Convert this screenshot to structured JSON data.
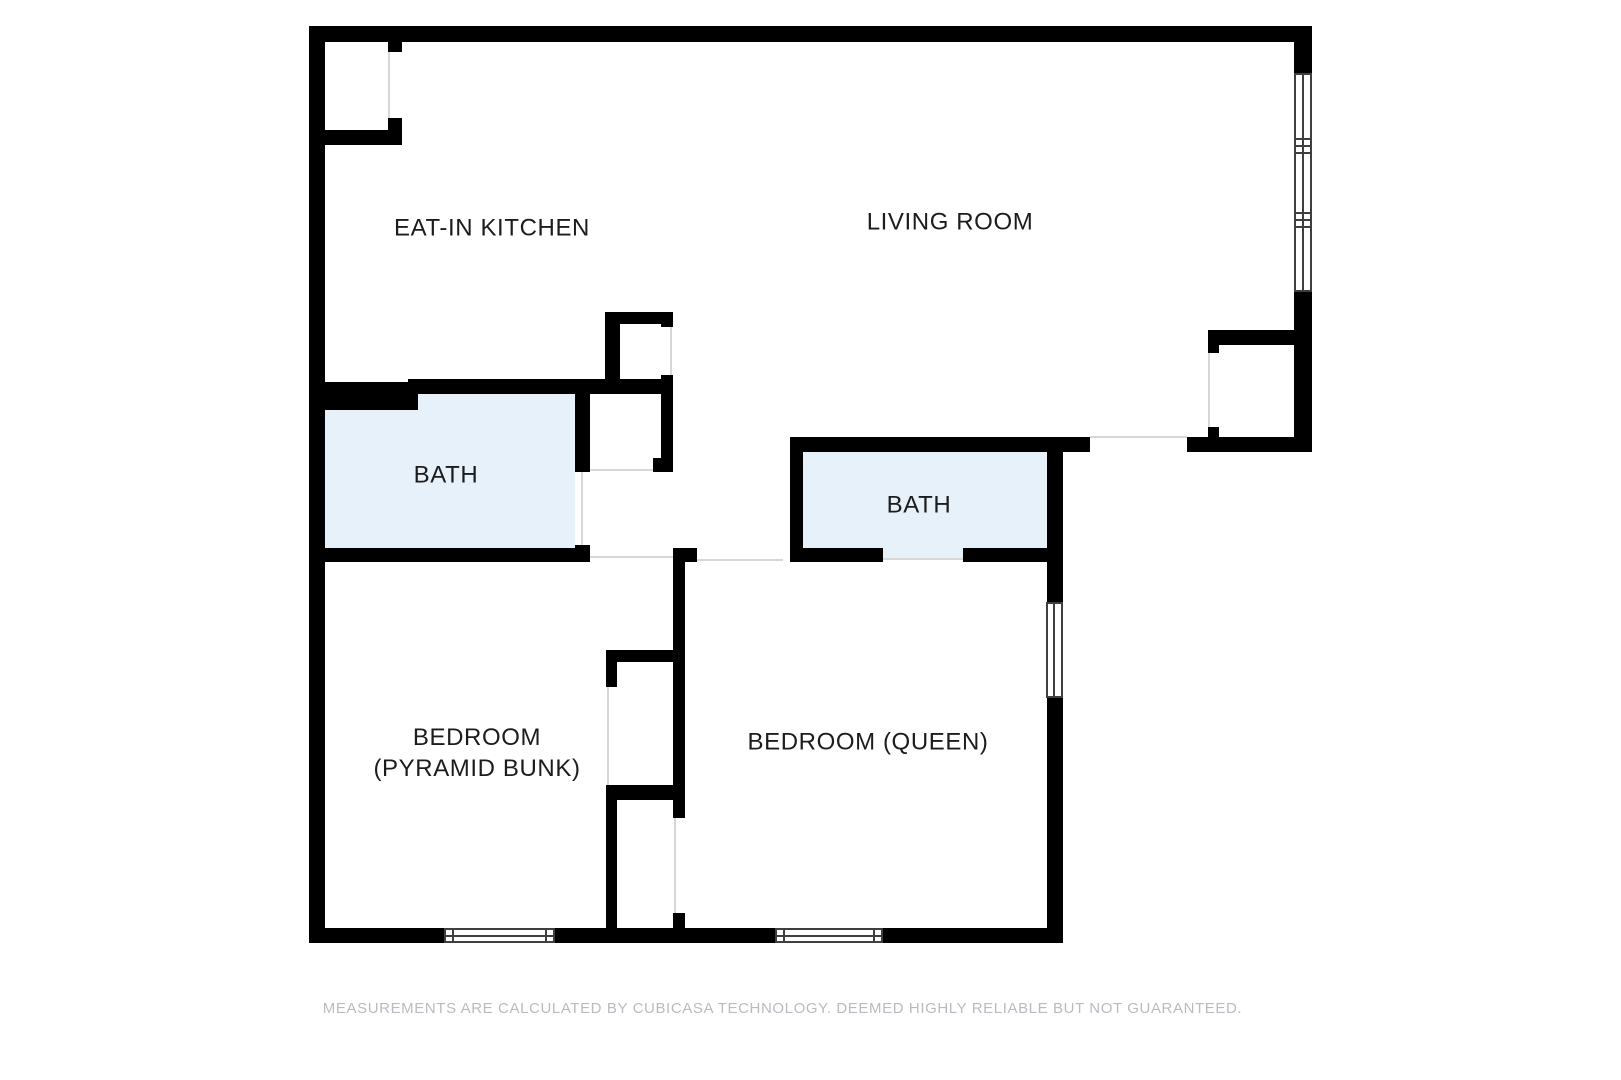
{
  "plan": {
    "colors": {
      "wall": "#000000",
      "bath_fill": "#e6f1fa",
      "opening": "#d7d7d7",
      "window_frame": "#3f3f3f",
      "label": "#1c1c1c",
      "disclaimer": "#b7bcc2"
    },
    "rooms": {
      "kitchen": {
        "label": "EAT-IN KITCHEN"
      },
      "living_room": {
        "label": "LIVING ROOM"
      },
      "bath_left": {
        "label": "BATH"
      },
      "bath_right": {
        "label": "BATH"
      },
      "bedroom_bunk": {
        "label_line1": "BEDROOM",
        "label_line2": "(PYRAMID BUNK)"
      },
      "bedroom_queen": {
        "label": "BEDROOM (QUEEN)"
      }
    }
  },
  "footer": {
    "disclaimer": "MEASUREMENTS ARE CALCULATED BY CUBICASA TECHNOLOGY. DEEMED HIGHLY RELIABLE BUT NOT GUARANTEED."
  }
}
